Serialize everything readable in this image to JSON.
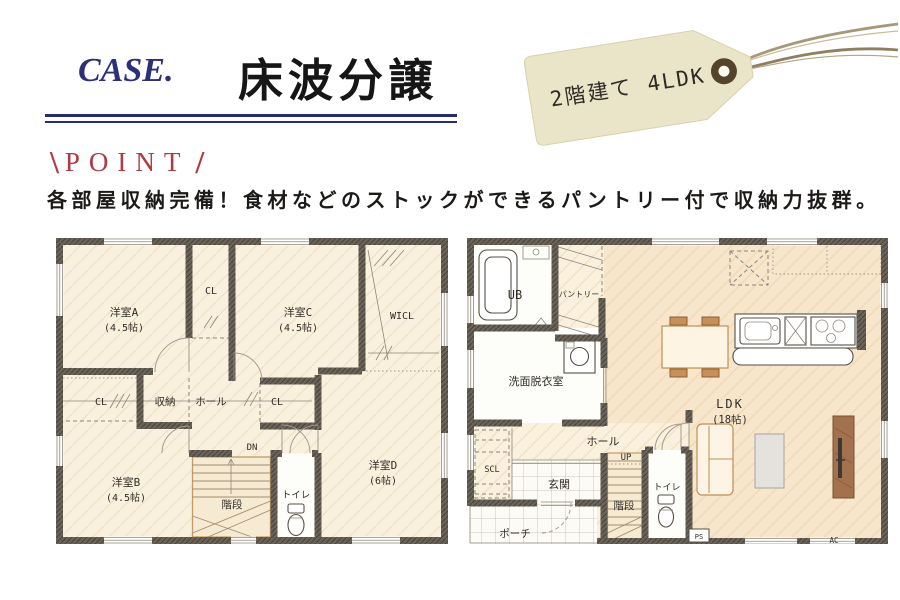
{
  "header": {
    "case_label": "CASE.",
    "title": "床波分譲",
    "tag_text": "2階建て 4LDK"
  },
  "point": {
    "slash_left": "\\",
    "label": "POINT",
    "slash_right": "/",
    "description": "各部屋収納完備！食材などのストックができるパントリー付で収納力抜群。"
  },
  "plan_2f": {
    "room_a_name": "洋室A",
    "room_a_size": "(4.5帖)",
    "cl_top": "CL",
    "room_c_name": "洋室C",
    "room_c_size": "(4.5帖)",
    "wicl": "WICL",
    "cl_left": "CL",
    "storage": "収納",
    "hall": "ホール",
    "cl_right": "CL",
    "room_b_name": "洋室B",
    "room_b_size": "(4.5帖)",
    "dn": "DN",
    "stairs": "階段",
    "toilet": "トイレ",
    "room_d_name": "洋室D",
    "room_d_size": "(6帖)"
  },
  "plan_1f": {
    "ub": "UB",
    "pantry": "パントリー",
    "washroom": "洗面脱衣室",
    "ldk_name": "LDK",
    "ldk_size": "(18帖)",
    "hall": "ホール",
    "up": "UP",
    "scl": "SCL",
    "entrance": "玄関",
    "porch": "ポーチ",
    "stairs": "階段",
    "toilet": "トイレ",
    "ps": "PS",
    "ac": "AC"
  },
  "colors": {
    "navy": "#272c6e",
    "point_red": "#b13a42",
    "tag_bg": "#eae4c8",
    "wall": "#6a635a",
    "floor": "#faf0de",
    "floor_ldk": "#f7e5cc"
  }
}
